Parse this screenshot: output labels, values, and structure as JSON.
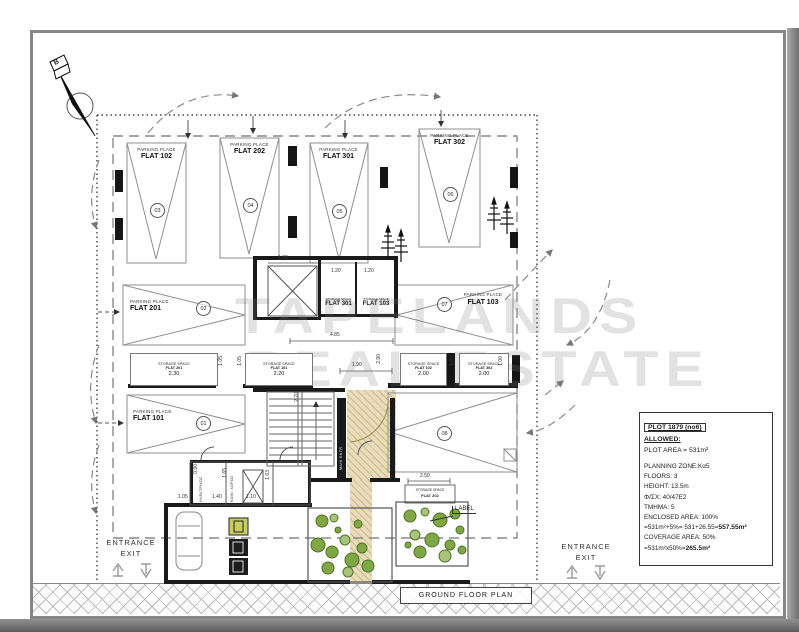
{
  "watermark": {
    "line1": "TAPELANDS",
    "line2": "REAL ESTATE"
  },
  "north": {
    "label": "B"
  },
  "parking": {
    "place_label": "PARKING PLACE",
    "spots": [
      {
        "flat": "FLAT 102",
        "num": "03"
      },
      {
        "flat": "FLAT 202",
        "num": "04"
      },
      {
        "flat": "FLAT 301",
        "num": "05"
      },
      {
        "flat": "FLAT 302",
        "num": "06"
      },
      {
        "flat": "FLAT 201",
        "num": "02"
      },
      {
        "flat": "FLAT 103",
        "num": "07"
      },
      {
        "flat": "FLAT 101",
        "num": "01"
      },
      {
        "flat": "",
        "num": "08"
      }
    ]
  },
  "storage": {
    "label": "STORAGE SPACE",
    "units": [
      {
        "flat": "FLAT 201",
        "dim": "2.30"
      },
      {
        "flat": "FLAT 101",
        "dim": "2.20"
      },
      {
        "flat": "FLAT 102",
        "dim": "2.00"
      },
      {
        "flat": "FLAT 302",
        "dim": "2.00"
      },
      {
        "flat": "FLAT 301",
        "dim": "1.20"
      },
      {
        "flat": "FLAT 103",
        "dim": "1.20"
      },
      {
        "flat": "FLAT 202",
        "dim": "2.50"
      }
    ]
  },
  "rooms": {
    "room1": "ΗΛΕΚΤΡΙΚΟΣ",
    "room2": "ΚΟΙΝ. ΧΩΡΟΣ",
    "main_entrance": "MAIN ENTR."
  },
  "dims": {
    "elevator_w": "1.80",
    "core_w": "4.85",
    "hall_w": "1.90",
    "hall_h": "2.70",
    "hall_h2": "2.90",
    "v105a": "1.05",
    "v105b": "1.05",
    "v100a": "1.00",
    "v100b": "1.00",
    "r105": "1.05",
    "r140": "1.40",
    "r110": "1.10",
    "v165": "1.65",
    "v163": "1.63",
    "v090": "0.90"
  },
  "annotations": {
    "label_callout": "LABEL",
    "plan_title": "GROUND FLOOR PLAN"
  },
  "entrances": {
    "left": {
      "line1": "ENTRANCE",
      "line2": "EXIT"
    },
    "right": {
      "line1": "ENTRANCE",
      "line2": "EXIT"
    }
  },
  "info_panel": {
    "title": "PLOT 1879 (no6)",
    "allowed": "ALLOWED:",
    "plot_area": "PLOT AREA = 531m²",
    "rows": [
      {
        "text": "PLANNING ZONE:Kα5",
        "bold": ""
      },
      {
        "text": "FLOORS:  3",
        "bold": ""
      },
      {
        "text": "HEIGHT:      13.5m",
        "bold": ""
      },
      {
        "text": "Φ/ΣΧ: 40/47E2",
        "bold": ""
      },
      {
        "text": "TMHMA: 5",
        "bold": ""
      },
      {
        "text": "ENCLOSED AREA: 100%",
        "bold": ""
      },
      {
        "text": "=531m²+5%= 531+26.55=",
        "bold": "557.55m²"
      },
      {
        "text": "COVERAGE AREA: 50%",
        "bold": ""
      },
      {
        "text": "=531m²x50%=",
        "bold": "265.5m²"
      }
    ]
  },
  "colors": {
    "bush_green": "#7fa845",
    "floor_tan": "#e9dcba",
    "wall": "#1a1a1a"
  }
}
